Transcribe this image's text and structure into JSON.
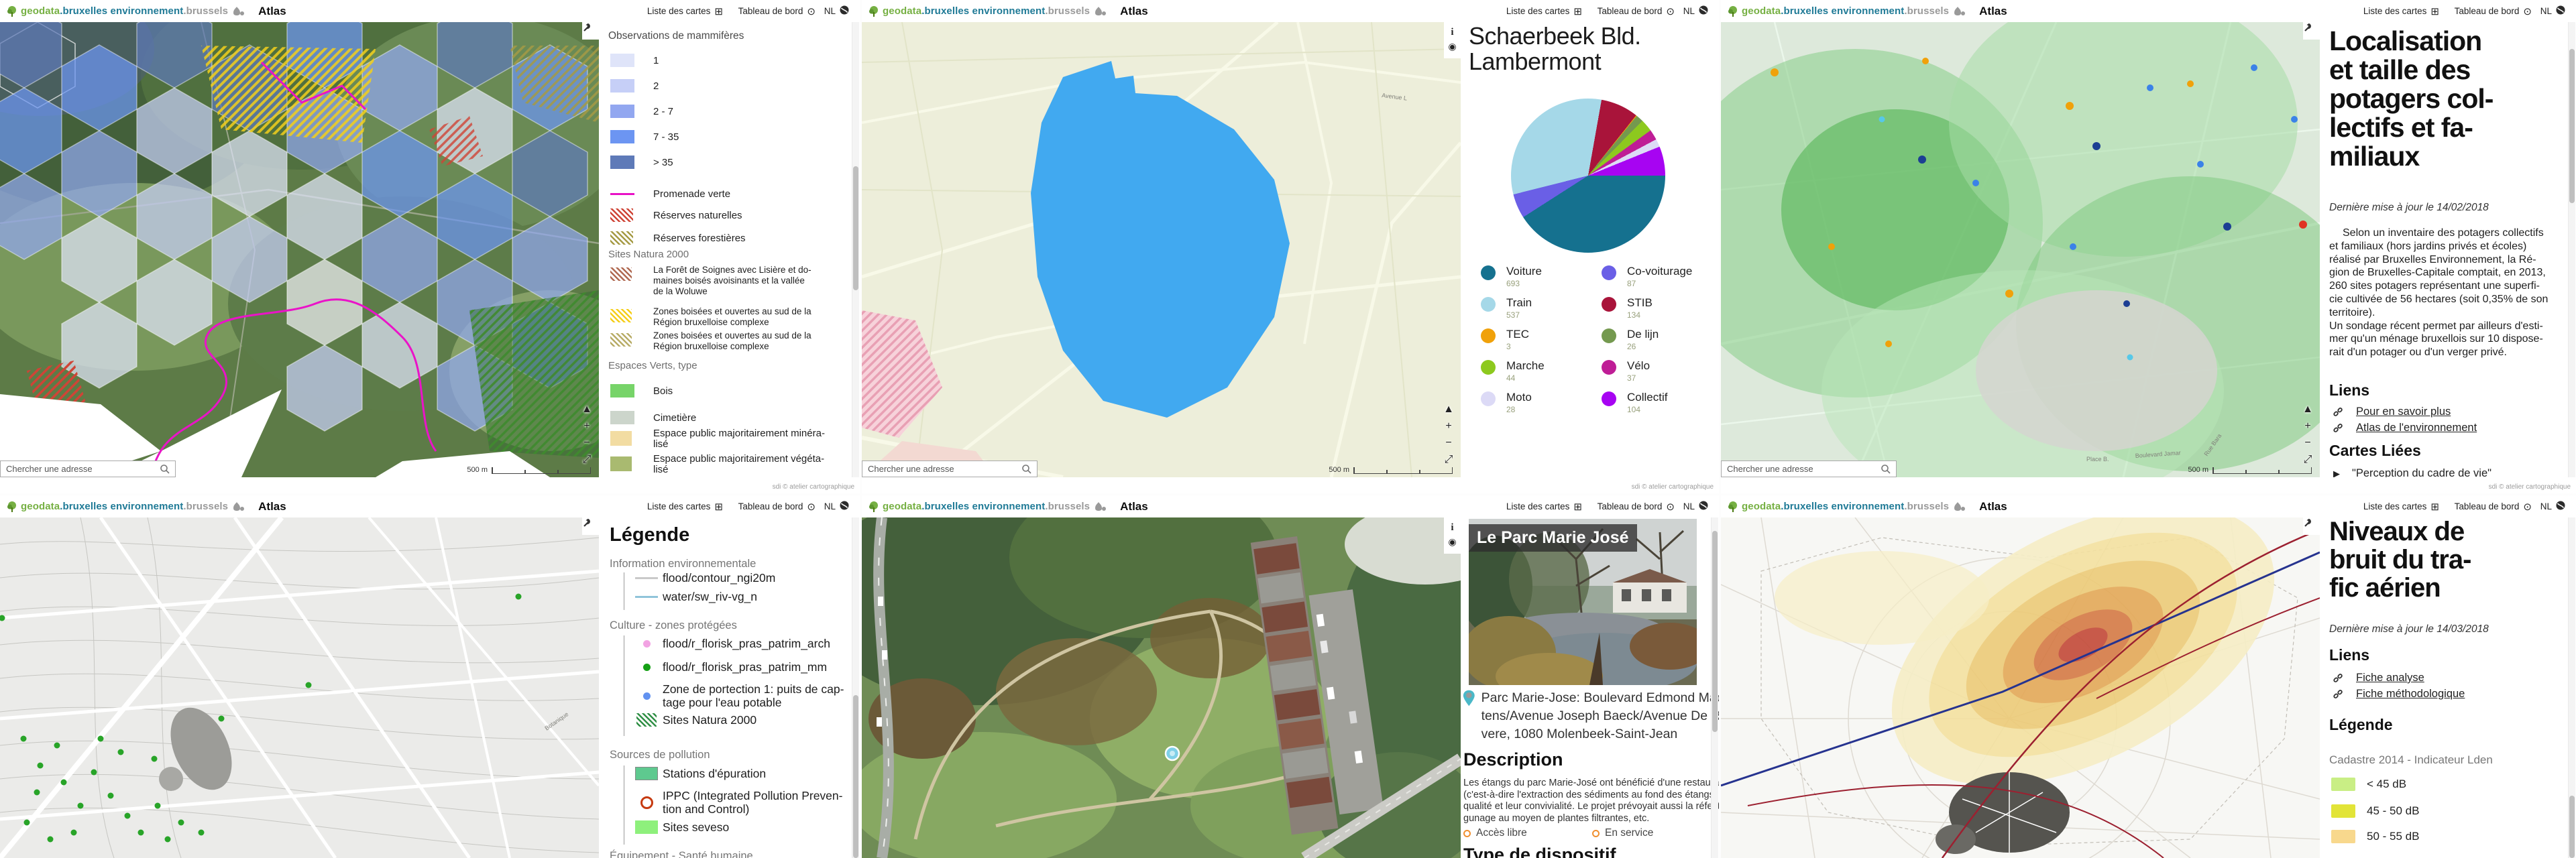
{
  "app_header": {
    "brand_geodata": "geodata",
    "brand_env": ".bruxelles environnement",
    "brand_brussels": ".brussels",
    "app_name": "Atlas",
    "nav_list": "Liste des cartes",
    "nav_dashboard": "Tableau de bord",
    "nav_lang": "NL"
  },
  "icons": {
    "grid": "⊞",
    "target": "⊙",
    "pan_up": "▲",
    "zoom_in": "+",
    "zoom_out": "−",
    "expand": "⤢",
    "info": "i",
    "locate": "◉",
    "play": "▶"
  },
  "map_ui": {
    "search_placeholder": "Chercher une adresse",
    "scale_label": "500 m",
    "attribution": "sdi © atelier cartographique"
  },
  "panel1": {
    "legend_title": "Observations de mammifères",
    "classes": [
      {
        "label": "1",
        "color": "#dfe4f9"
      },
      {
        "label": "2",
        "color": "#c6cff7"
      },
      {
        "label": "2 - 7",
        "color": "#92a7f0"
      },
      {
        "label": "7 - 35",
        "color": "#6c95f2"
      },
      {
        "label": "> 35",
        "color": "#5e7ab8"
      }
    ],
    "line_items": [
      {
        "label": "Promenade verte",
        "color": "#e811c6"
      },
      {
        "label": "Réserves naturelles",
        "color": "#cf4436"
      },
      {
        "label": "Réserves forestières",
        "color": "#a59a44"
      }
    ],
    "natura_title": "Sites Natura 2000",
    "natura_items": [
      {
        "label": "La Forêt de Soignes avec Lisière et do-\nmaines boisés avoisinants et la vallée\nde la Woluwe",
        "color": "#b06a52"
      },
      {
        "label": "Zones boisées et ouvertes au sud de la\nRégion bruxelloise complexe",
        "color": "#f5ce1a"
      },
      {
        "label": "Zones boisées et ouvertes au sud de la\nRégion bruxelloise complexe",
        "color": "#b8ac66"
      }
    ],
    "espaces_title": "Espaces Verts, type",
    "espaces_items": [
      {
        "label": "Bois",
        "color": "#77d469"
      },
      {
        "label": "Cimetière",
        "color": "#ccd5cb"
      },
      {
        "label": "Espace public majoritairement minéra-\nlisé",
        "color": "#f2dca2"
      },
      {
        "label": "Espace public majoritairement végéta-\nlisé",
        "color": "#a9ba70"
      }
    ]
  },
  "panel2": {
    "title": "Schaerbeek Bld.\nLambermont",
    "map_label": "Avenue L"
  },
  "chart_data": {
    "type": "pie",
    "title": "Schaerbeek Bld. Lambermont",
    "legend_position": "bottom",
    "slices": [
      {
        "name": "Voiture",
        "value": 693,
        "color": "#15718f"
      },
      {
        "name": "Train",
        "value": 537,
        "color": "#a5d8e8"
      },
      {
        "name": "TEC",
        "value": 3,
        "color": "#f0a10a"
      },
      {
        "name": "Marche",
        "value": 44,
        "color": "#8dc91e"
      },
      {
        "name": "Moto",
        "value": 28,
        "color": "#dcdaf6"
      },
      {
        "name": "Co-voiturage",
        "value": 87,
        "color": "#6a5fe6"
      },
      {
        "name": "STIB",
        "value": 134,
        "color": "#a9143a"
      },
      {
        "name": "De lijn",
        "value": 26,
        "color": "#74994f"
      },
      {
        "name": "Vélo",
        "value": 37,
        "color": "#bf1d96"
      },
      {
        "name": "Collectif",
        "value": 104,
        "color": "#a704f2"
      }
    ],
    "draw_order": [
      "Voiture",
      "Co-voiturage",
      "Train",
      "STIB",
      "TEC",
      "De lijn",
      "Marche",
      "Vélo",
      "Moto",
      "Collectif"
    ],
    "start_angle_deg": 90
  },
  "panel3": {
    "title": "Localisation\net taille des\npotagers col-\nlectifs et fa-\nmiliaux",
    "updated": "Dernière mise à jour le  14/02/2018",
    "body": "Selon un inventaire des potagers collectifs\net familiaux (hors jardins privés et écoles)\nréalisé par Bruxelles Environnement, la Ré-\ngion de Bruxelles-Capitale comptait, en 2013,\n260 sites potagers représentant une superfi-\ncie cultivée de 56 hectares (soit 0,35% de son\nterritoire).\nUn sondage récent permet par ailleurs d'esti-\nmer qu'un ménage bruxellois sur 10 dispose-\nrait d'un potager ou d'un verger privé.",
    "liens_title": "Liens",
    "links": [
      {
        "label": "Pour en savoir plus"
      },
      {
        "label": "Atlas de l'environnement"
      }
    ],
    "cartes_title": "Cartes Liées",
    "carte_item": "\"Perception du cadre de vie\"",
    "map_labels": {
      "l1": "Place B.",
      "l2": "Boulevard Jamar",
      "l3": "Rue Bara"
    }
  },
  "panel4": {
    "legend_title": "Légende",
    "sec1_title": "Information environnementale",
    "sec1_items": [
      {
        "label": "flood/contour_ngi20m",
        "color": "#c9c9c9"
      },
      {
        "label": "water/sw_riv-vg_n",
        "color": "#90c4da"
      }
    ],
    "sec2_title": "Culture - zones protégées",
    "sec2_items": [
      {
        "label": "flood/r_florisk_pras_patrim_arch",
        "color": "#f2a3e3"
      },
      {
        "label": "flood/r_florisk_pras_patrim_mm",
        "color": "#15a015"
      },
      {
        "label": "Zone de portection 1: puits de cap-\ntage pour l'eau potable",
        "color": "#6292f0"
      },
      {
        "label": "Sites Natura 2000",
        "color": "#2f8f45"
      }
    ],
    "sec3_title": "Sources de pollution",
    "sec3_items": [
      {
        "label": "Stations d'épuration",
        "color": "#5ec98f"
      },
      {
        "label": "IPPC (Integrated Pollution Preven-\ntion and Control)",
        "color": "#c63a10"
      },
      {
        "label": "Sites seveso",
        "color": "#8ef07c"
      }
    ],
    "sec4_title": "Équipement - Santé humaine",
    "map_label": "Botanique"
  },
  "panel5": {
    "photo_title": "Le Parc Marie José",
    "address": "Parc Marie-Jose: Boulevard Edmond Mach\ntens/Avenue Joseph Baeck/Avenue De Roo\nvere, 1080 Molenbeek-Saint-Jean",
    "description_title": "Description",
    "description": "Les étangs du parc Marie-José ont bénéficié d'une restauration et\n(c'est-à-dire l'extraction des sédiments au fond des étangs) pour an\nqualité et leur convivialité. Le projet prévoyait aussi la réfection des b\ngunage au moyen de plantes filtrantes, etc.",
    "tag1": "Accès libre",
    "tag2": "En service",
    "type_title": "Type de dispositif"
  },
  "panel6": {
    "title": "Niveaux de\nbruit du tra-\nfic aérien",
    "updated": "Dernière mise à jour le  14/03/2018",
    "liens_title": "Liens",
    "links": [
      {
        "label": "Fiche analyse"
      },
      {
        "label": "Fiche méthodologique"
      }
    ],
    "legend_title": "Légende",
    "legend_subtitle": "Cadastre 2014 - Indicateur Lden",
    "legend_items": [
      {
        "label": "< 45 dB",
        "color": "#c9ee85"
      },
      {
        "label": "45 - 50 dB",
        "color": "#e2e438"
      },
      {
        "label": "50 - 55 dB",
        "color": "#f8d88d"
      }
    ]
  }
}
